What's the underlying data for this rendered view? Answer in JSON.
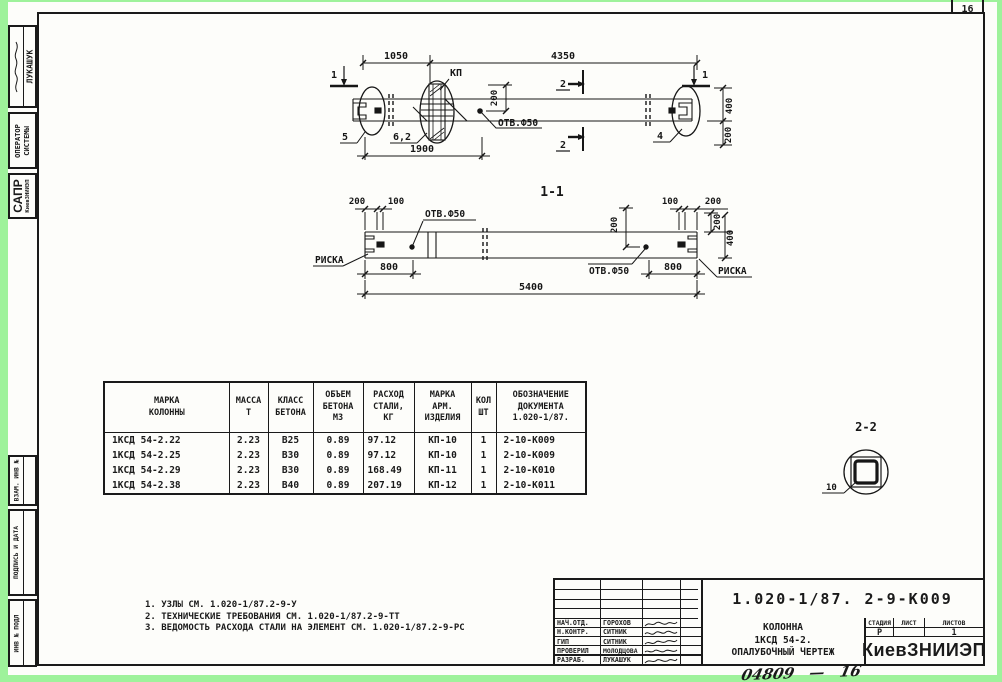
{
  "page": {
    "corner_number": "16",
    "bottom_note": "04809",
    "bottom_note_dash": "—",
    "bottom_note2": "16"
  },
  "colors": {
    "scan_border": "#9ef29b",
    "ink": "#1a1a1a",
    "paper": "#fdfdfa"
  },
  "sidebar": {
    "stamp_name": "ЛУКАШУК",
    "operator_line1": "ОПЕРАТОР",
    "operator_line2": "СИСТЕМЫ",
    "sapr": "САПР",
    "sapr_sub": "КиевЗНИИЭП",
    "vzam": "ВЗАМ. ИНВ №",
    "podpis": "ПОДПИСЬ И ДАТА",
    "inv_podl": "ИНВ № ПОДЛ"
  },
  "elevation": {
    "dim_1050": "1050",
    "dim_4350": "4350",
    "kp": "КП",
    "dim_200_mid": "200",
    "otv": "ОТВ.Ф50",
    "sec1_left": "1",
    "sec1_right": "1",
    "sec2_top": "2",
    "sec2_bot": "2",
    "label_5": "5",
    "label_6_2": "6,2",
    "dim_1900": "1900",
    "label_4": "4",
    "dim_400": "400",
    "dim_200_right": "200"
  },
  "section_1_1": {
    "title": "1-1",
    "dim_200_tl": "200",
    "dim_100_tl": "100",
    "dim_100_tr": "100",
    "dim_200_tr": "200",
    "otv_left": "ОТВ.Ф50",
    "otv_right": "ОТВ.Ф50",
    "dim_200_mid": "200",
    "dim_200_r": "200",
    "dim_400_r": "400",
    "riska_left": "РИСКА",
    "riska_right": "РИСКА",
    "dim_800_l": "800",
    "dim_800_r": "800",
    "dim_5400": "5400"
  },
  "detail_2_2": {
    "title": "2-2",
    "dim_10": "10"
  },
  "table": {
    "headers": [
      "МАРКА\nКОЛОННЫ",
      "МАССА\nТ",
      "КЛАСС\nБЕТОНА",
      "ОБЪЕМ\nБЕТОНА\nМ3",
      "РАСХОД\nСТАЛИ,\nКГ",
      "МАРКА\nАРМ.\nИЗДЕЛИЯ",
      "КОЛ\nШТ",
      "ОБОЗНАЧЕНИЕ\nДОКУМЕНТА\n1.020-1/87."
    ],
    "rows": [
      [
        "1КСД 54-2.22",
        "2.23",
        "В25",
        "0.89",
        "97.12",
        "КП-10",
        "1",
        "2-10-К009"
      ],
      [
        "1КСД 54-2.25",
        "2.23",
        "В30",
        "0.89",
        "97.12",
        "КП-10",
        "1",
        "2-10-К009"
      ],
      [
        "1КСД 54-2.29",
        "2.23",
        "В30",
        "0.89",
        "168.49",
        "КП-11",
        "1",
        "2-10-К010"
      ],
      [
        "1КСД 54-2.38",
        "2.23",
        "В40",
        "0.89",
        "207.19",
        "КП-12",
        "1",
        "2-10-К011"
      ]
    ]
  },
  "notes": {
    "line1": "1. УЗЛЫ СМ. 1.020-1/87.2-9-У",
    "line2": "2. ТЕХНИЧЕСКИЕ ТРЕБОВАНИЯ СМ. 1.020-1/87.2-9-ТТ",
    "line3": "3. ВЕДОМОСТЬ РАСХОДА СТАЛИ НА ЭЛЕМЕНТ СМ. 1.020-1/87.2-9-РС"
  },
  "titleblock": {
    "doc_number": "1.020-1/87. 2-9-К009",
    "staff": [
      {
        "role": "НАЧ.ОТД.",
        "name": "ГОРОХОВ"
      },
      {
        "role": "Н.КОНТР.",
        "name": "СИТНИК"
      },
      {
        "role": "ГИП",
        "name": "СИТНИК"
      },
      {
        "role": "ПРОВЕРИЛ",
        "name": "МОЛОДЦОВА"
      },
      {
        "role": "РАЗРАБ.",
        "name": "ЛУКАШУК"
      }
    ],
    "title_line1": "КОЛОННА",
    "title_line2": "1КСД 54-2.",
    "title_line3": "ОПАЛУБОЧНЫЙ ЧЕРТЕЖ",
    "stage_label": "СТАДИЯ",
    "sheet_label": "ЛИСТ",
    "sheets_label": "ЛИСТОВ",
    "stage_value": "Р",
    "sheet_value": "",
    "sheets_value": "1",
    "org": "КиевЗНИИЭП"
  }
}
